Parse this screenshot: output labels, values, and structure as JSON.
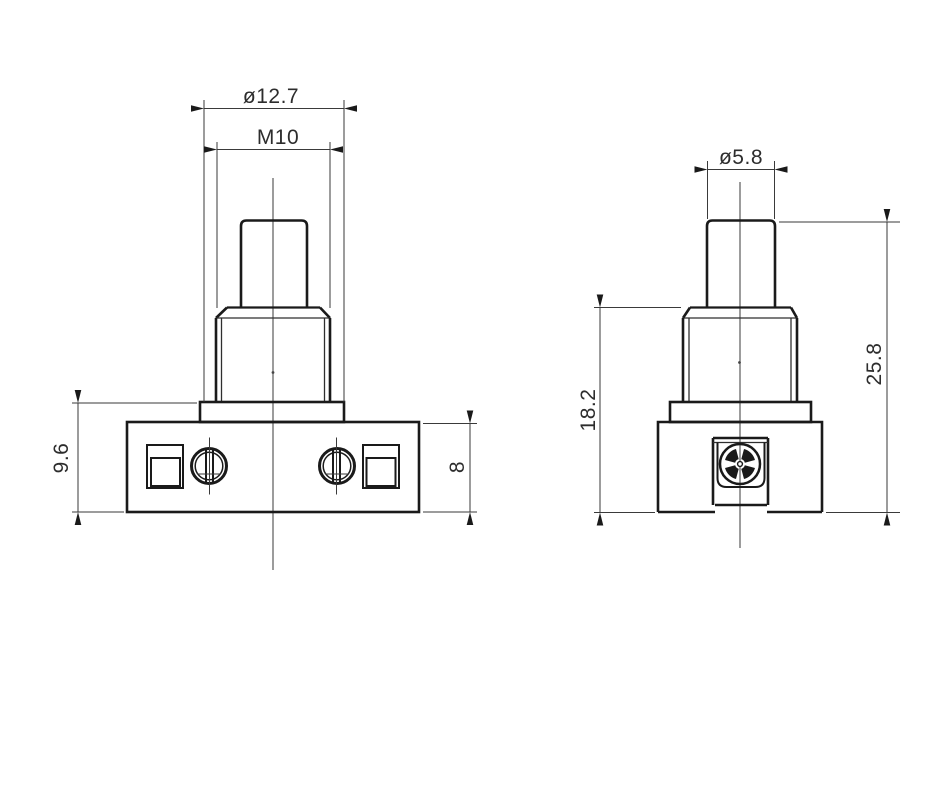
{
  "drawing": {
    "component": "push button switch",
    "background": "#ffffff",
    "line_color": "#1a1a1a",
    "front_view": {
      "dim_flange_diameter": "ø12.7",
      "dim_thread": "M10",
      "dim_flange_plus_body_height": "9.6",
      "dim_body_height": "8"
    },
    "side_view": {
      "dim_button_diameter": "ø5.8",
      "dim_bushing_base_height": "18.2",
      "dim_overall_height": "25.8"
    }
  }
}
